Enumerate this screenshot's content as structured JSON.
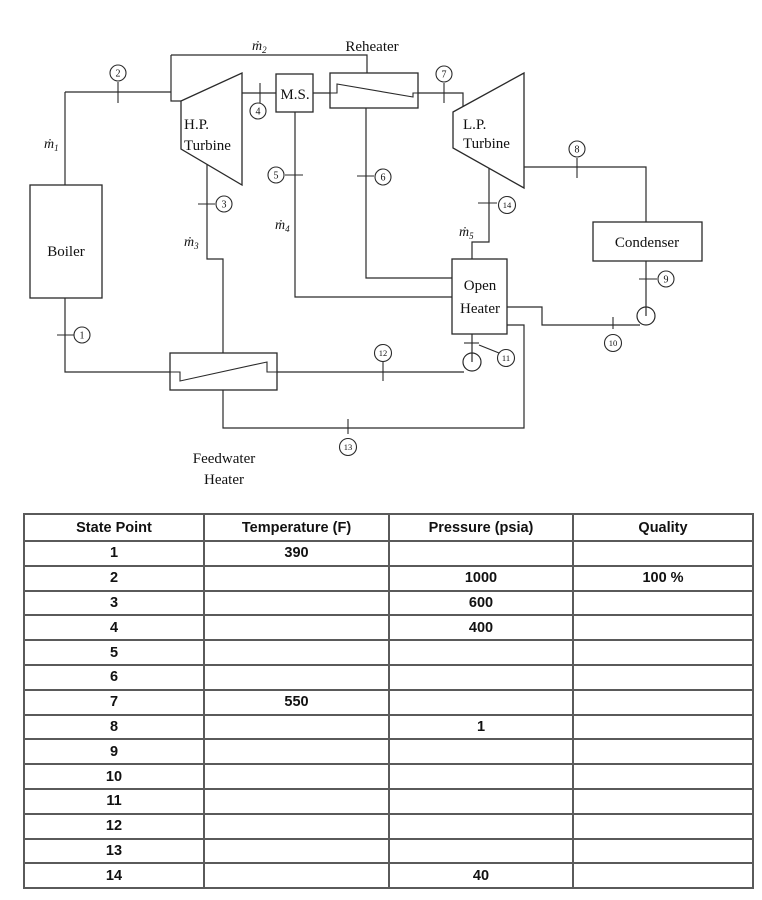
{
  "diagram": {
    "reheater_label": "Reheater",
    "components": {
      "boiler": "Boiler",
      "hp_line1": "H.P.",
      "hp_line2": "Turbine",
      "ms": "M.S.",
      "lp_line1": "L.P.",
      "lp_line2": "Turbine",
      "condenser": "Condenser",
      "open_heater_line1": "Open",
      "open_heater_line2": "Heater",
      "fwh_line1": "Feedwater",
      "fwh_line2": "Heater"
    },
    "mass_flows": {
      "base": "ṁ",
      "subs": [
        "1",
        "2",
        "3",
        "4",
        "5"
      ]
    },
    "state_points": [
      "1",
      "2",
      "3",
      "4",
      "5",
      "6",
      "7",
      "8",
      "9",
      "10",
      "11",
      "12",
      "13",
      "14"
    ]
  },
  "table": {
    "headers": [
      "State Point",
      "Temperature (F)",
      "Pressure (psia)",
      "Quality"
    ],
    "rows": [
      {
        "state": "1",
        "temp": "390",
        "pressure": "",
        "quality": ""
      },
      {
        "state": "2",
        "temp": "",
        "pressure": "1000",
        "quality": "100 %"
      },
      {
        "state": "3",
        "temp": "",
        "pressure": "600",
        "quality": ""
      },
      {
        "state": "4",
        "temp": "",
        "pressure": "400",
        "quality": ""
      },
      {
        "state": "5",
        "temp": "",
        "pressure": "",
        "quality": ""
      },
      {
        "state": "6",
        "temp": "",
        "pressure": "",
        "quality": ""
      },
      {
        "state": "7",
        "temp": "550",
        "pressure": "",
        "quality": ""
      },
      {
        "state": "8",
        "temp": "",
        "pressure": "1",
        "quality": ""
      },
      {
        "state": "9",
        "temp": "",
        "pressure": "",
        "quality": ""
      },
      {
        "state": "10",
        "temp": "",
        "pressure": "",
        "quality": ""
      },
      {
        "state": "11",
        "temp": "",
        "pressure": "",
        "quality": ""
      },
      {
        "state": "12",
        "temp": "",
        "pressure": "",
        "quality": ""
      },
      {
        "state": "13",
        "temp": "",
        "pressure": "",
        "quality": ""
      },
      {
        "state": "14",
        "temp": "",
        "pressure": "40",
        "quality": ""
      }
    ]
  },
  "colors": {
    "line": "#2a2a2a",
    "table_border": "#5a5a5a",
    "text": "#111111"
  }
}
